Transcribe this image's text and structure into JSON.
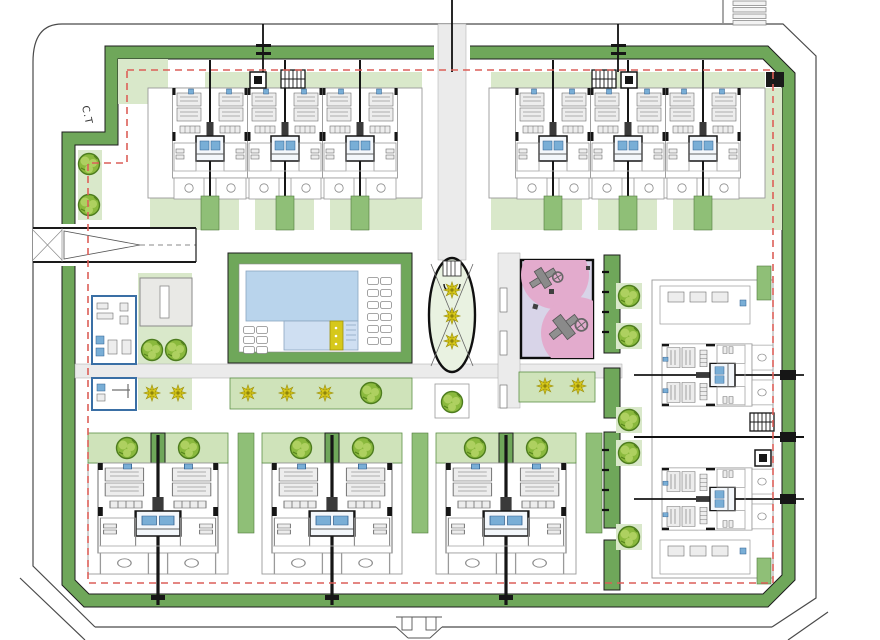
{
  "labels": {
    "ct": "C.T"
  },
  "colors": {
    "hedge_band": "#6fa75a",
    "light_green": "#d9e8ca",
    "lawn": "#cfe3ba",
    "hedge_path": "#8fbf77",
    "tree": "#8ab93d",
    "flower": "#d6c81b",
    "setback_red": "#dc5f58",
    "road_gray": "#ebebeb",
    "pool_blue": "#b9d4ec",
    "pool_blue_light": "#cfdff2",
    "playground_lavender": "#d8d4e8",
    "playground_pink": "#e3abcd",
    "fixture_blue": "#79aed6",
    "facility_outline_blue": "#3a6fa5",
    "wall_dark": "#1c1c1c"
  }
}
